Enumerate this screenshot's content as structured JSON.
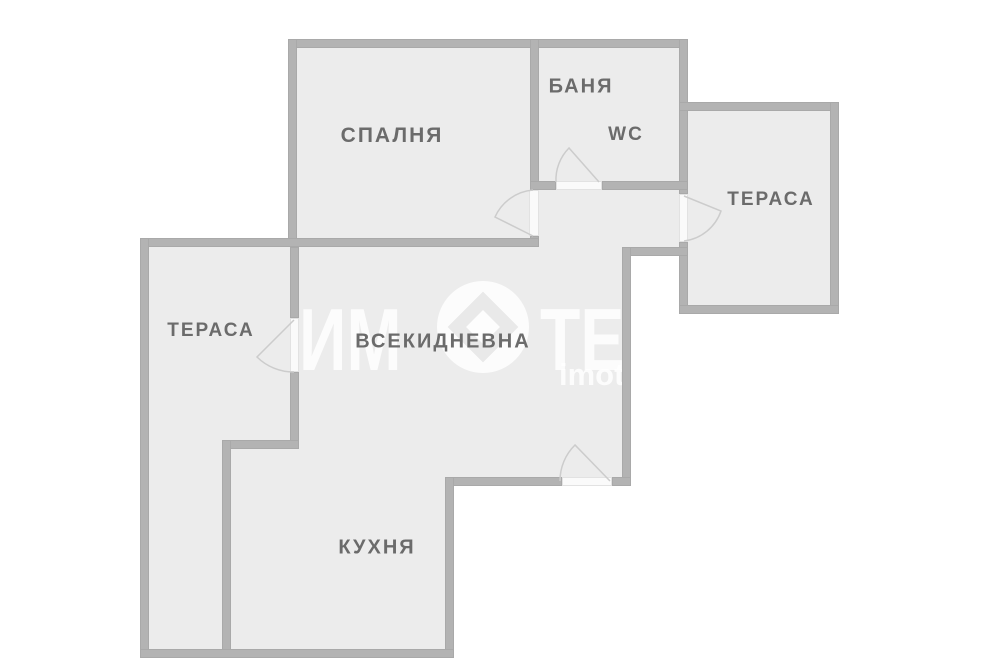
{
  "floorplan": {
    "rooms": [
      {
        "id": "bedroom",
        "label": "СПАЛНЯ"
      },
      {
        "id": "bathroom",
        "label": "БАНЯ"
      },
      {
        "id": "wc",
        "label": "WC"
      },
      {
        "id": "terrace_right",
        "label": "ТЕРАСА"
      },
      {
        "id": "terrace_left",
        "label": "ТЕРАСА"
      },
      {
        "id": "living_room",
        "label": "ВСЕКИДНЕВНА"
      },
      {
        "id": "kitchen",
        "label": "КУХНЯ"
      }
    ],
    "watermark": {
      "brand_left": "ИМ",
      "brand_right": "ТЕКА",
      "brand_full": "ИМОТЕКА",
      "site": "imoteka"
    },
    "colors": {
      "background": "#ffffff",
      "floor": "#ececec",
      "wall": "#b3b3b3",
      "label_text": "#6b6b6b",
      "door_arc": "#cccccc",
      "watermark": "#ffffff"
    }
  }
}
